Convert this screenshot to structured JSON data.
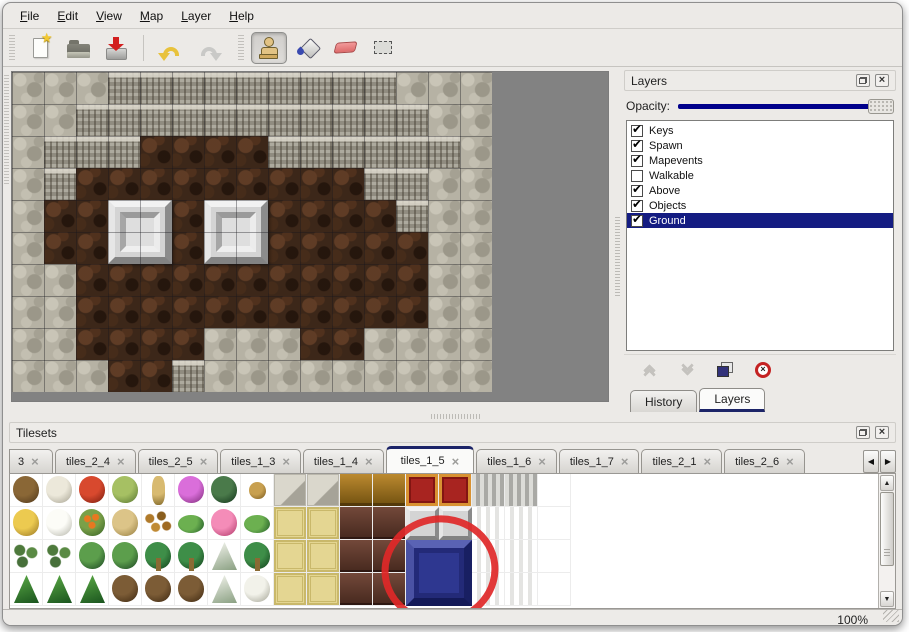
{
  "menu": {
    "items": [
      {
        "key": "F",
        "rest": "ile"
      },
      {
        "key": "E",
        "rest": "dit"
      },
      {
        "key": "V",
        "rest": "iew"
      },
      {
        "key": "M",
        "rest": "ap"
      },
      {
        "key": "L",
        "rest": "ayer"
      },
      {
        "key": "H",
        "rest": "elp"
      }
    ]
  },
  "toolbar": {
    "icons": [
      "new-file-icon",
      "open-file-icon",
      "save-file-icon",
      "undo-icon",
      "redo-icon",
      "stamp-tool-icon",
      "fill-tool-icon",
      "eraser-tool-icon",
      "select-tool-icon"
    ],
    "active_tool": "stamp"
  },
  "layers_panel": {
    "title": "Layers",
    "opacity_label": "Opacity:",
    "opacity_value_percent": 100,
    "layers": [
      {
        "label": "Keys",
        "checked": true,
        "selected": false
      },
      {
        "label": "Spawn",
        "checked": true,
        "selected": false
      },
      {
        "label": "Mapevents",
        "checked": true,
        "selected": false
      },
      {
        "label": "Walkable",
        "checked": false,
        "selected": false
      },
      {
        "label": "Above",
        "checked": true,
        "selected": false
      },
      {
        "label": "Objects",
        "checked": true,
        "selected": false
      },
      {
        "label": "Ground",
        "checked": true,
        "selected": true
      }
    ],
    "buttons": [
      "raise-layer",
      "lower-layer",
      "duplicate-layer",
      "delete-layer"
    ],
    "tabs": [
      {
        "label": "History",
        "active": false
      },
      {
        "label": "Layers",
        "active": true
      }
    ]
  },
  "tilesets_panel": {
    "title": "Tilesets",
    "tabs": [
      {
        "label": "3",
        "active": false,
        "partial": true
      },
      {
        "label": "tiles_2_4",
        "active": false
      },
      {
        "label": "tiles_2_5",
        "active": false
      },
      {
        "label": "tiles_1_3",
        "active": false
      },
      {
        "label": "tiles_1_4",
        "active": false
      },
      {
        "label": "tiles_1_5",
        "active": true
      },
      {
        "label": "tiles_1_6",
        "active": false
      },
      {
        "label": "tiles_1_7",
        "active": false
      },
      {
        "label": "tiles_2_1",
        "active": false
      },
      {
        "label": "tiles_2_6",
        "active": false
      }
    ]
  },
  "map": {
    "tile_size": 32,
    "legend": {
      "R": "rock",
      "C": "cliff-face",
      "F": "brown-floor"
    },
    "rows": [
      "RRRCCCCCCCCCRRR",
      "RRCCCCCCCCCCCRR",
      "RCCCFFFFCCCCCCR",
      "RCFFFFFFFFFCCRR",
      "RFFFFFFFFFFFCRR",
      "RFFFFFFFFFFFFRR",
      "RRFFFFFFFFFFFRR",
      "RRFFFFFFFFFFFRR",
      "RRFFFFRRRFFRRRR",
      "RRRFFCRRRRRRRRR"
    ],
    "pillars": [
      {
        "col": 3,
        "row": 4
      },
      {
        "col": 6,
        "row": 4
      }
    ]
  },
  "tileset_grid": {
    "cell_size": 33,
    "rows": [
      [
        "barewood",
        "snagwhite",
        "bloomred",
        "stumpgreen",
        "trunktan",
        "bloompurple",
        "fern",
        "twig",
        "stone",
        "stone",
        "wood",
        "wood",
        "rug",
        "rug",
        "curtg",
        "curtg",
        "empty"
      ],
      [
        "hay",
        "snowmound",
        "bloomorange",
        "tuft",
        "leaves",
        "lilypad",
        "bloompink",
        "lilypad",
        "mat",
        "mat",
        "woodd",
        "woodd",
        "silver",
        "silver",
        "curtw",
        "curtw",
        "empty"
      ],
      [
        "sprig",
        "sprig",
        "bush",
        "bush",
        "palm",
        "palm",
        "pinesnow",
        "palm",
        "mat",
        "mat",
        "woodd",
        "woodd",
        "blue",
        "blue",
        "curtw",
        "curtw",
        "empty"
      ],
      [
        "conetree",
        "conetree",
        "conetree",
        "gnarl",
        "gnarl",
        "gnarl",
        "pinesnow",
        "snowtree",
        "mat",
        "mat",
        "woodd",
        "woodd",
        "blue",
        "blue",
        "curtw",
        "curtw",
        "empty"
      ]
    ],
    "blue_block": {
      "col": 12,
      "row": 2,
      "span": 2
    },
    "highlight": {
      "shape": "ellipse",
      "cx": 430,
      "cy": 96,
      "rx": 55,
      "ry": 51,
      "stroke": "#e02828",
      "stroke_width": 7
    }
  },
  "statusbar": {
    "zoom_level": "100%"
  },
  "glyphs": {
    "check": "✔",
    "close": "×",
    "star": "★",
    "up": "▲",
    "down": "▼",
    "left": "◀",
    "right": "▶",
    "delete_x": "×"
  },
  "colors": {
    "selection_blue": "#141c82",
    "slider_blue": "#00008b",
    "tab_accent": "#1c2468",
    "annotation_red": "#e02828"
  }
}
